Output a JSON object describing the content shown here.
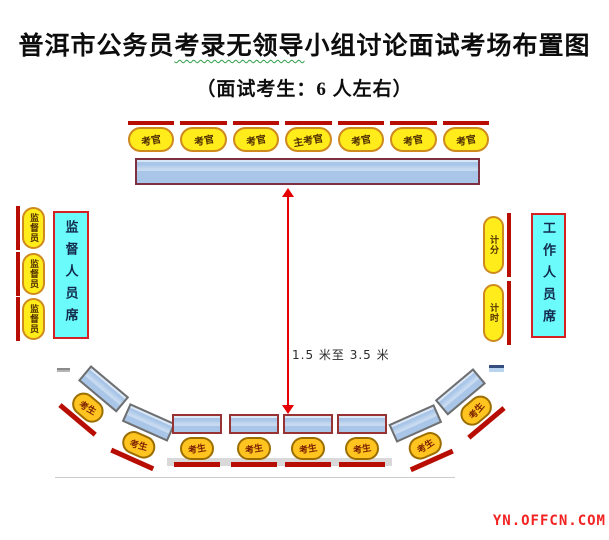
{
  "title": {
    "part1": "普洱市公务员",
    "part2_underlined": "考录无领导",
    "part3": "小组讨论面试考场布置图"
  },
  "subtitle": "（面试考生：6 人左右）",
  "examiner_row": {
    "labels": [
      "考官",
      "考官",
      "考官",
      "主考官",
      "考官",
      "考官",
      "考官"
    ]
  },
  "supervisor_area": {
    "chair_labels": [
      "监督员",
      "监督员",
      "监督员"
    ],
    "panel_label": "监督人员席"
  },
  "staff_area": {
    "chair_labels": [
      "计分",
      "计时"
    ],
    "panel_label": "工作人员席"
  },
  "distance_arrow": {
    "label": "1.5 米至 3.5 米"
  },
  "candidate_row": {
    "labels": [
      "考生",
      "考生",
      "考生",
      "考生",
      "考生",
      "考生",
      "考生",
      "考生"
    ]
  },
  "watermark": "YN.OFFCN.COM",
  "colors": {
    "chair_back_red": "#b70d02",
    "seat_yellow": "#ffec1a",
    "candidate_orange": "#ffc41f",
    "table_blue": "#a9c6e8",
    "table_border_maroon": "#7c3040",
    "panel_cyan": "#6bfbfb",
    "panel_border_red": "#d42222",
    "arrow_red": "#e60000",
    "underline_green": "#2f9e44",
    "watermark_red": "#f32222"
  }
}
